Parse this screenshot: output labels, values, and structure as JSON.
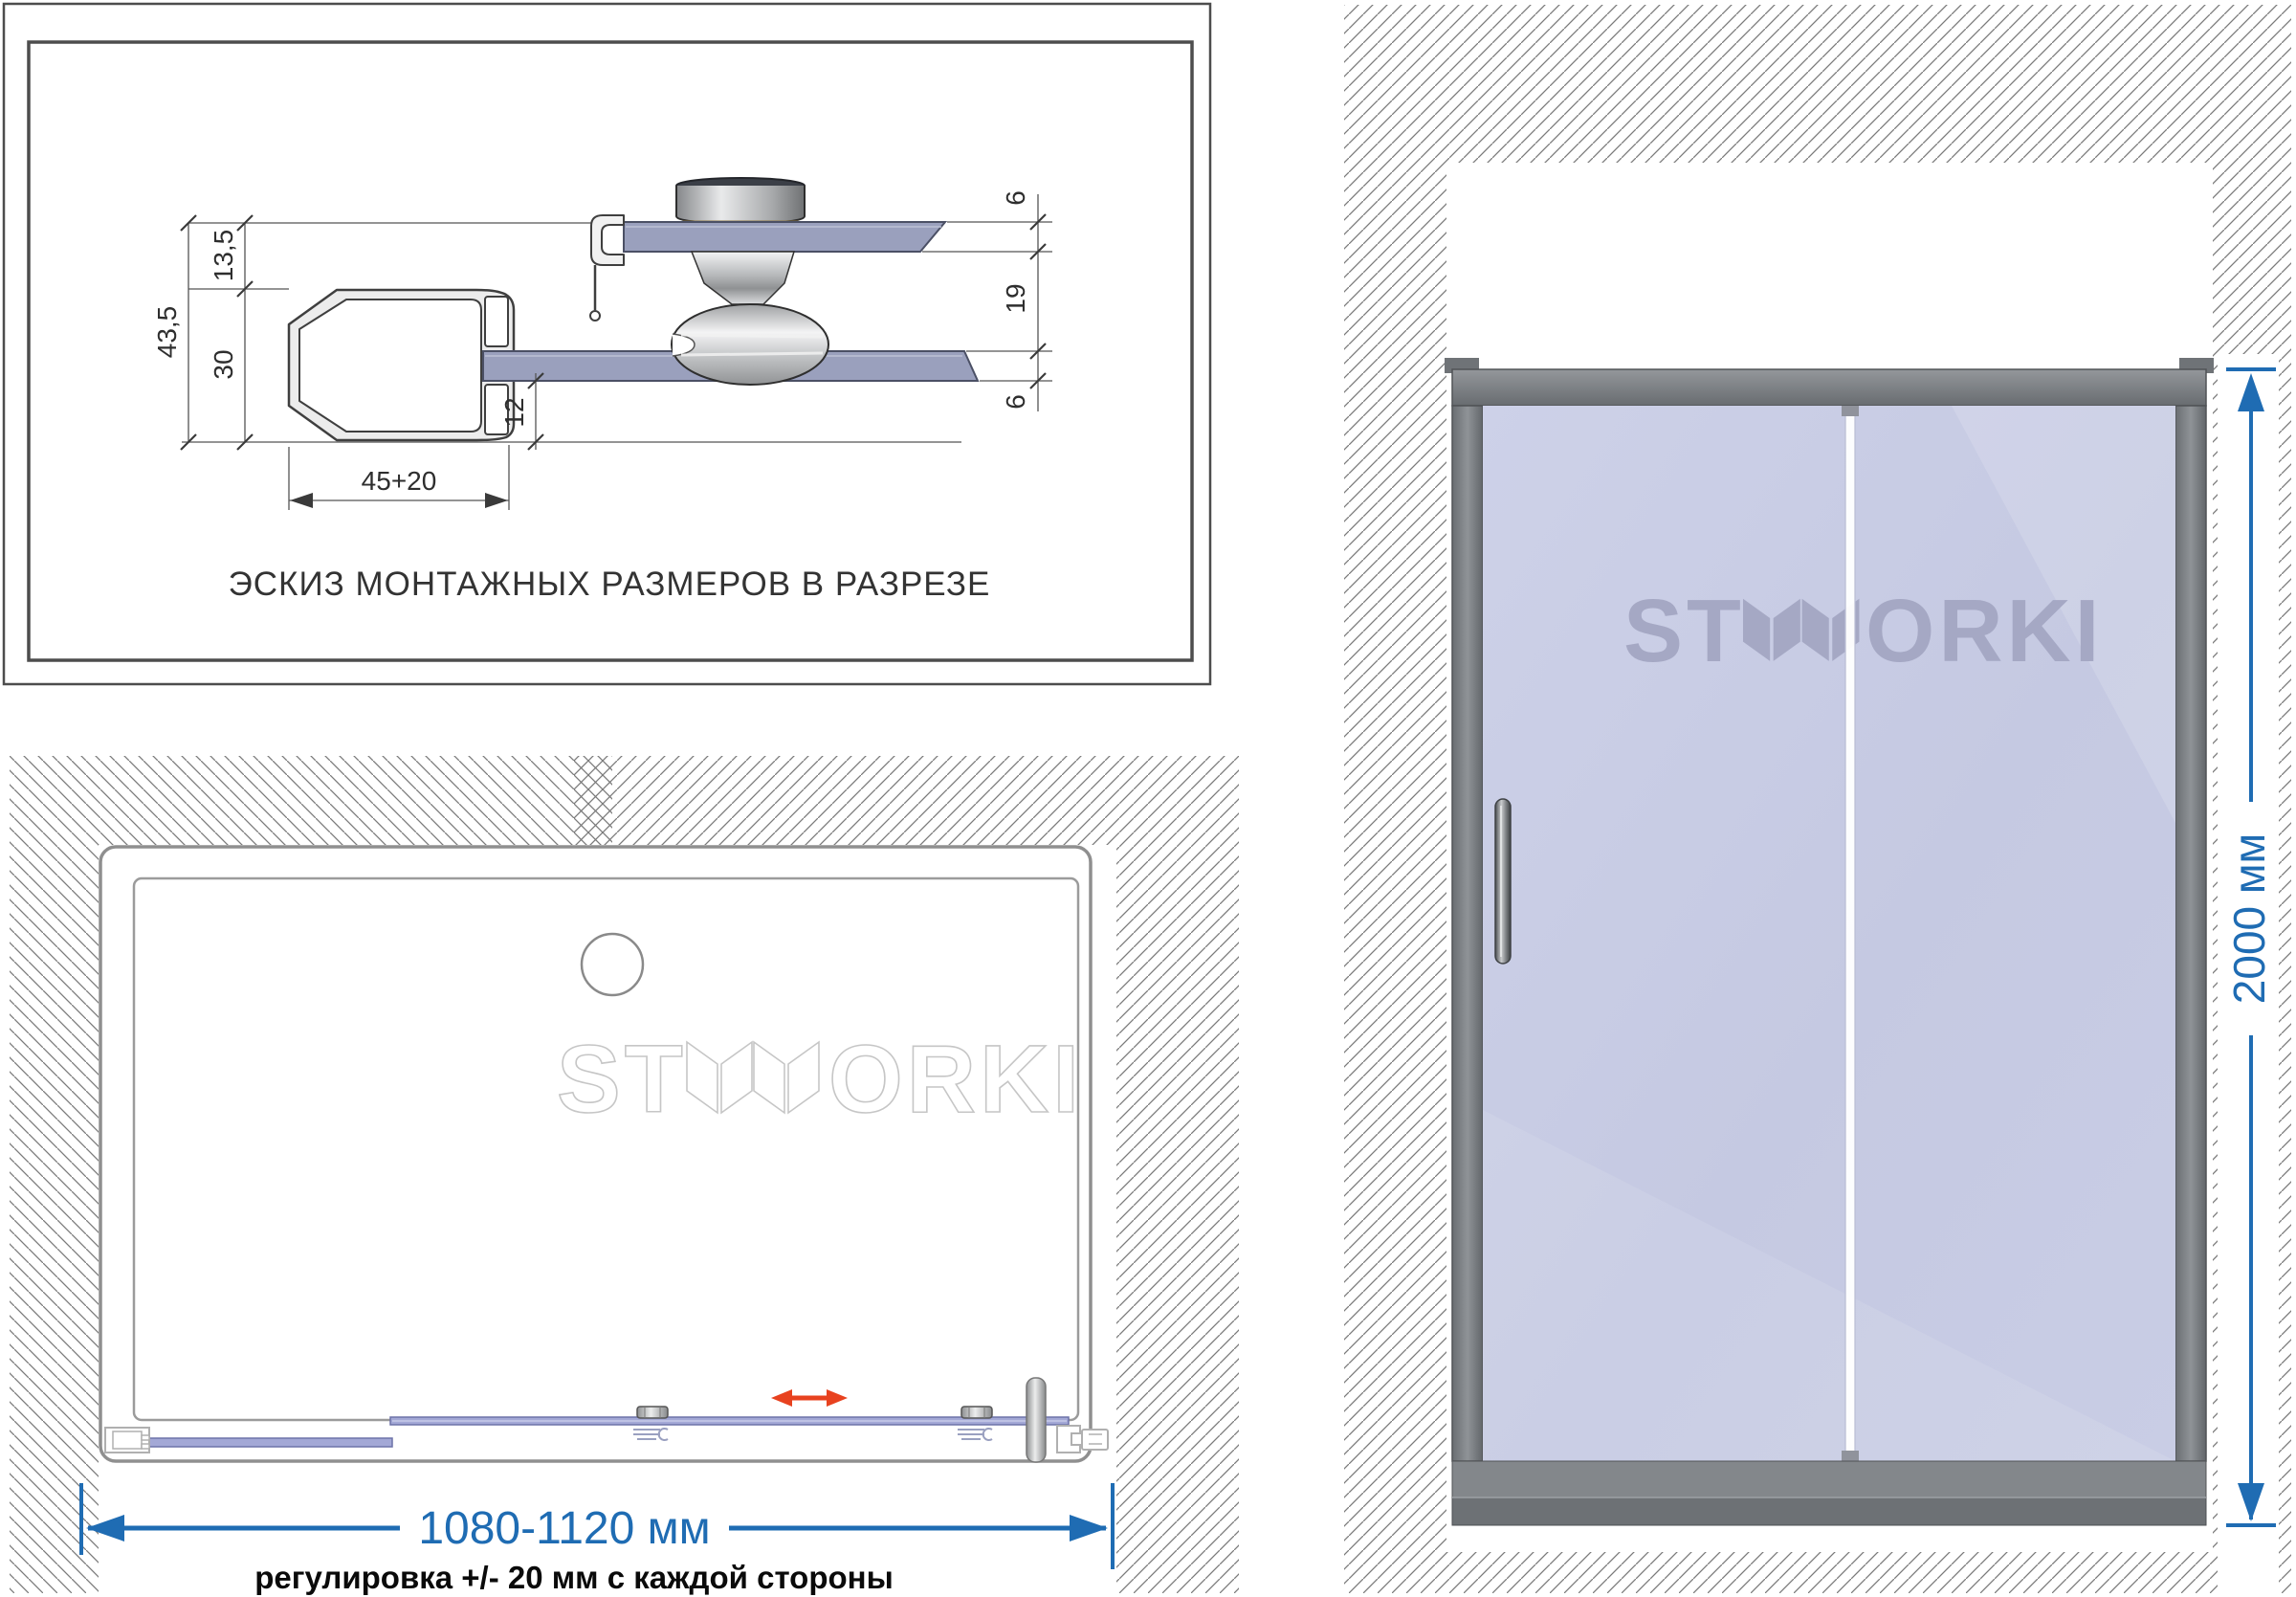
{
  "section_view": {
    "caption": "ЭСКИЗ МОНТАЖНЫХ РАЗМЕРОВ В РАЗРЕЗЕ",
    "dim_total_height": "43,5",
    "dim_top_offset": "13,5",
    "dim_profile_height": "30",
    "dim_glass_to_bottom": "12",
    "dim_profile_width": "45+20",
    "dim_fixed_glass_thickness": "6",
    "dim_roller_gap": "19",
    "dim_door_glass_thickness": "6"
  },
  "plan_view": {
    "watermark_prefix": "ST",
    "watermark_suffix": "ORKI",
    "width_dimension": "1080-1120 мм",
    "adjustment_note": "регулировка +/- 20 мм с каждой стороны"
  },
  "front_view": {
    "logo_prefix": "ST",
    "logo_suffix": "ORKI",
    "height_dimension": "2000 мм"
  },
  "colors": {
    "dimension_blue": "#1f6cb3",
    "arrow_red": "#e8421f",
    "glass_lavender": "#c7cbe4",
    "glass_section": "#9aa0bd",
    "frame_gray": "#74787c",
    "hatch_gray": "#7a7a7a"
  }
}
